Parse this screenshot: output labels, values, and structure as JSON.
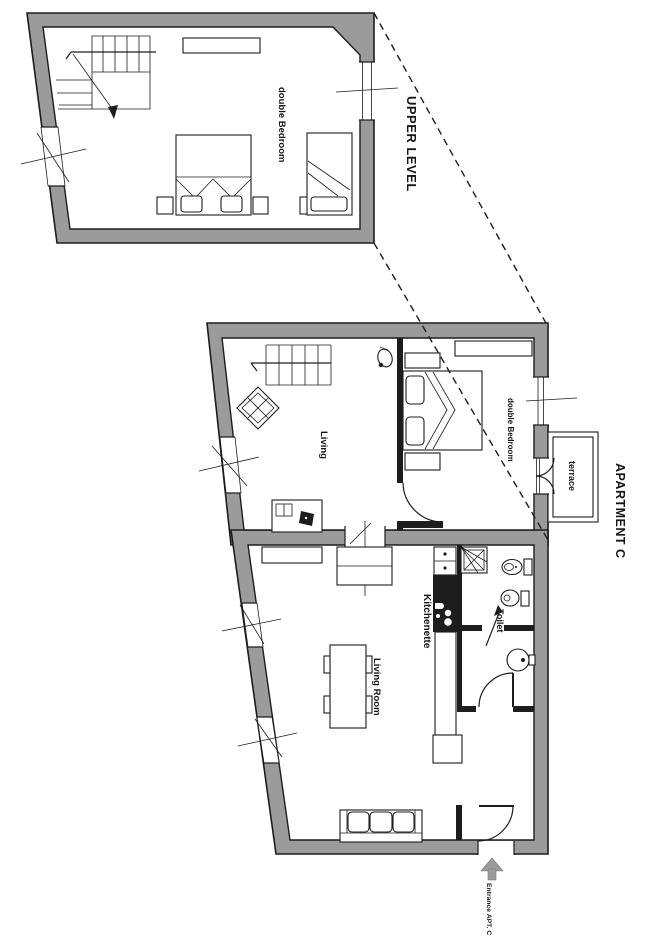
{
  "title": "Apartment C floor plan",
  "labels": {
    "upper_level": "UPPER LEVEL",
    "apartment": "APARTMENT C",
    "entrance": "Entrance APT. C"
  },
  "rooms": {
    "upper_bedroom": "double Bedroom",
    "living": "Living",
    "bedroom": "double Bedroom",
    "terrace": "terrace",
    "living_room": "Living Room",
    "kitchenette": "Kitchenette",
    "toilet": "Toilet"
  },
  "colors": {
    "wall": "#9b9b9b",
    "line": "#1d1d1d",
    "bg": "#ffffff",
    "arrow": "#9b9b9b"
  }
}
